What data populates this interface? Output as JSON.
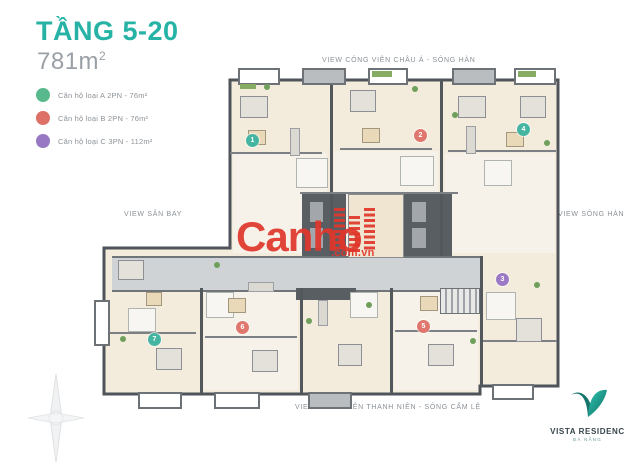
{
  "header": {
    "floor_title": "TẦNG 5-20",
    "area": "781m",
    "area_superscript": "2"
  },
  "legend": {
    "items": [
      {
        "label": "Căn hộ loại A 2PN - 76m²",
        "color": "#58b98c",
        "type": "A"
      },
      {
        "label": "Căn hộ loại B 2PN - 76m²",
        "color": "#dd7067",
        "type": "B"
      },
      {
        "label": "Căn hộ loại C 3PN - 112m²",
        "color": "#9878c2",
        "type": "C"
      }
    ]
  },
  "view_labels": {
    "top": "VIEW CÔNG VIÊN CHÂU Á - SÔNG HÀN",
    "left": "VIEW SÂN BAY",
    "right": "VIEW SÔNG HÀN",
    "bottom": "VIEW CÔNG VIÊN THANH NIÊN - SÔNG CẨM LỆ"
  },
  "plan": {
    "units": [
      {
        "number": "1",
        "type": "A"
      },
      {
        "number": "2",
        "type": "B"
      },
      {
        "number": "4",
        "type": "A"
      },
      {
        "number": "3",
        "type": "C"
      },
      {
        "number": "5",
        "type": "B"
      },
      {
        "number": "6",
        "type": "B"
      },
      {
        "number": "7",
        "type": "A"
      }
    ]
  },
  "watermark": {
    "brand": "Canho",
    "domain": ".com.vn"
  },
  "logo": {
    "brand": "VISTA RESIDENC",
    "subtitle": "ĐÀ NẴNG"
  }
}
